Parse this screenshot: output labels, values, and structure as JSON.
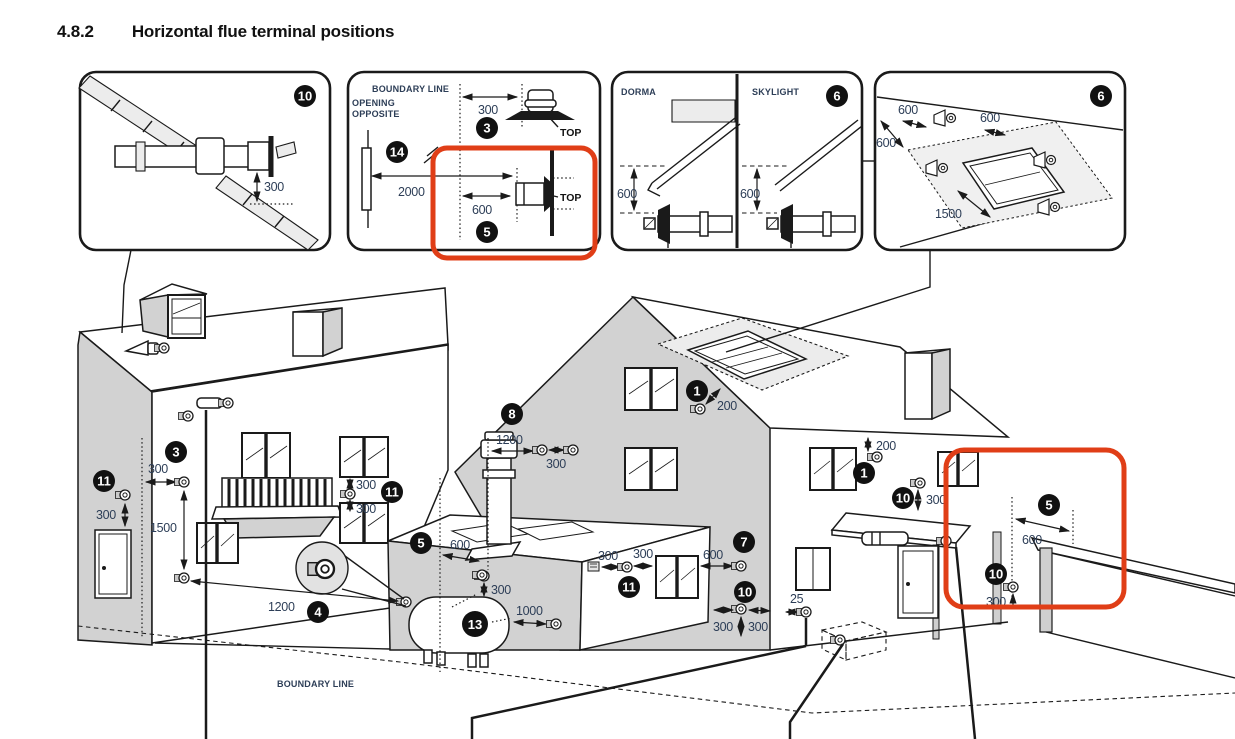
{
  "title": {
    "section": "4.8.2",
    "text": "Horizontal flue terminal positions"
  },
  "colors": {
    "highlight_red": "#e03e17",
    "dimension_text": "#2d3e57",
    "wall_gray": "#d2d2d2",
    "badge": "#111111"
  },
  "boxes": {
    "pitched_roof": {
      "badge": "10",
      "dim": "300"
    },
    "boundary": {
      "boundary_label": "BOUNDARY LINE",
      "opening_line1": "OPENING",
      "opening_line2": "OPPOSITE",
      "badge_top": "3",
      "badge_opening": "14",
      "badge_bottom": "5",
      "dim_300": "300",
      "dim_2000": "2000",
      "dim_600": "600",
      "top_label_1": "TOP",
      "top_label_2": "TOP"
    },
    "dorma_skylight": {
      "badge": "6",
      "label_left": "DORMA",
      "label_right": "SKYLIGHT",
      "dim_left": "600",
      "dim_right": "600"
    },
    "skylight_plan": {
      "badge": "6",
      "dim_top_left": "600",
      "dim_top_right": "600",
      "dim_left": "600",
      "dim_bottom": "1500"
    }
  },
  "scene": {
    "boundary_label": "BOUNDARY LINE",
    "side_door": {
      "badge": "11",
      "dim": "300"
    },
    "left_wall": {
      "badge": "3",
      "dim_h": "300",
      "dim_v": "1500"
    },
    "balcony_windows": {
      "badge": "11",
      "dim_top": "300",
      "dim_bottom": "300"
    },
    "facing": {
      "badge": "4",
      "dim": "1200"
    },
    "flat_roof": {
      "badge": "5",
      "dim": "600",
      "dim_below": "300"
    },
    "gable": {
      "badge": "8",
      "dim_h": "1200",
      "dim_pair": "300"
    },
    "tank": {
      "badge": "13",
      "dim_v": "300",
      "dim_h": "1000"
    },
    "vent": {
      "badge": "11",
      "dim_left": "300",
      "dim_right": "300"
    },
    "corner": {
      "badge": "7",
      "dim": "600"
    },
    "ground_corner": {
      "badge": "10",
      "dim_left": "300",
      "dim_right": "300"
    },
    "below_ground": {
      "dim": "25"
    },
    "verge": {
      "badge": "1",
      "dim": "200"
    },
    "eaves": {
      "badge": "1",
      "dim": "200"
    },
    "canopy_above": {
      "badge": "10",
      "dim": "300"
    },
    "fence": {
      "badge": "5",
      "dim": "600"
    },
    "fence_low": {
      "badge": "10",
      "dim": "300"
    }
  }
}
